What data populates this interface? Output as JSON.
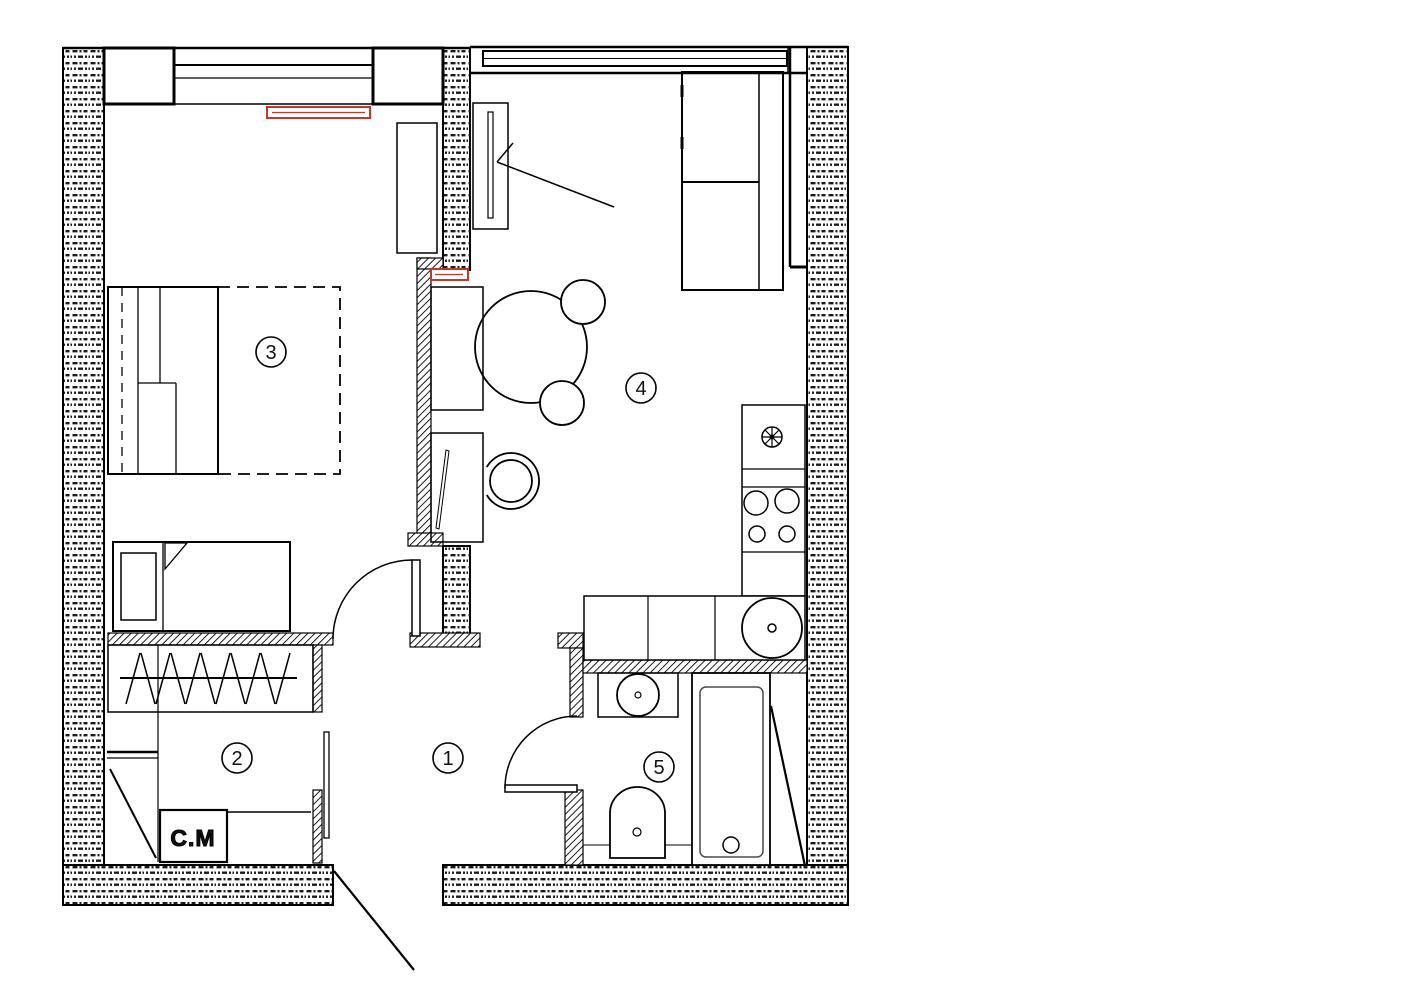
{
  "plan_labels": {
    "rooms": [
      {
        "number": "1"
      },
      {
        "number": "2"
      },
      {
        "number": "3"
      },
      {
        "number": "4"
      },
      {
        "number": "5"
      }
    ],
    "washing_machine": "C.M"
  },
  "colors": {
    "radiator_red": "#c0392b",
    "wall_ink": "#000000",
    "background": "#ffffff"
  }
}
